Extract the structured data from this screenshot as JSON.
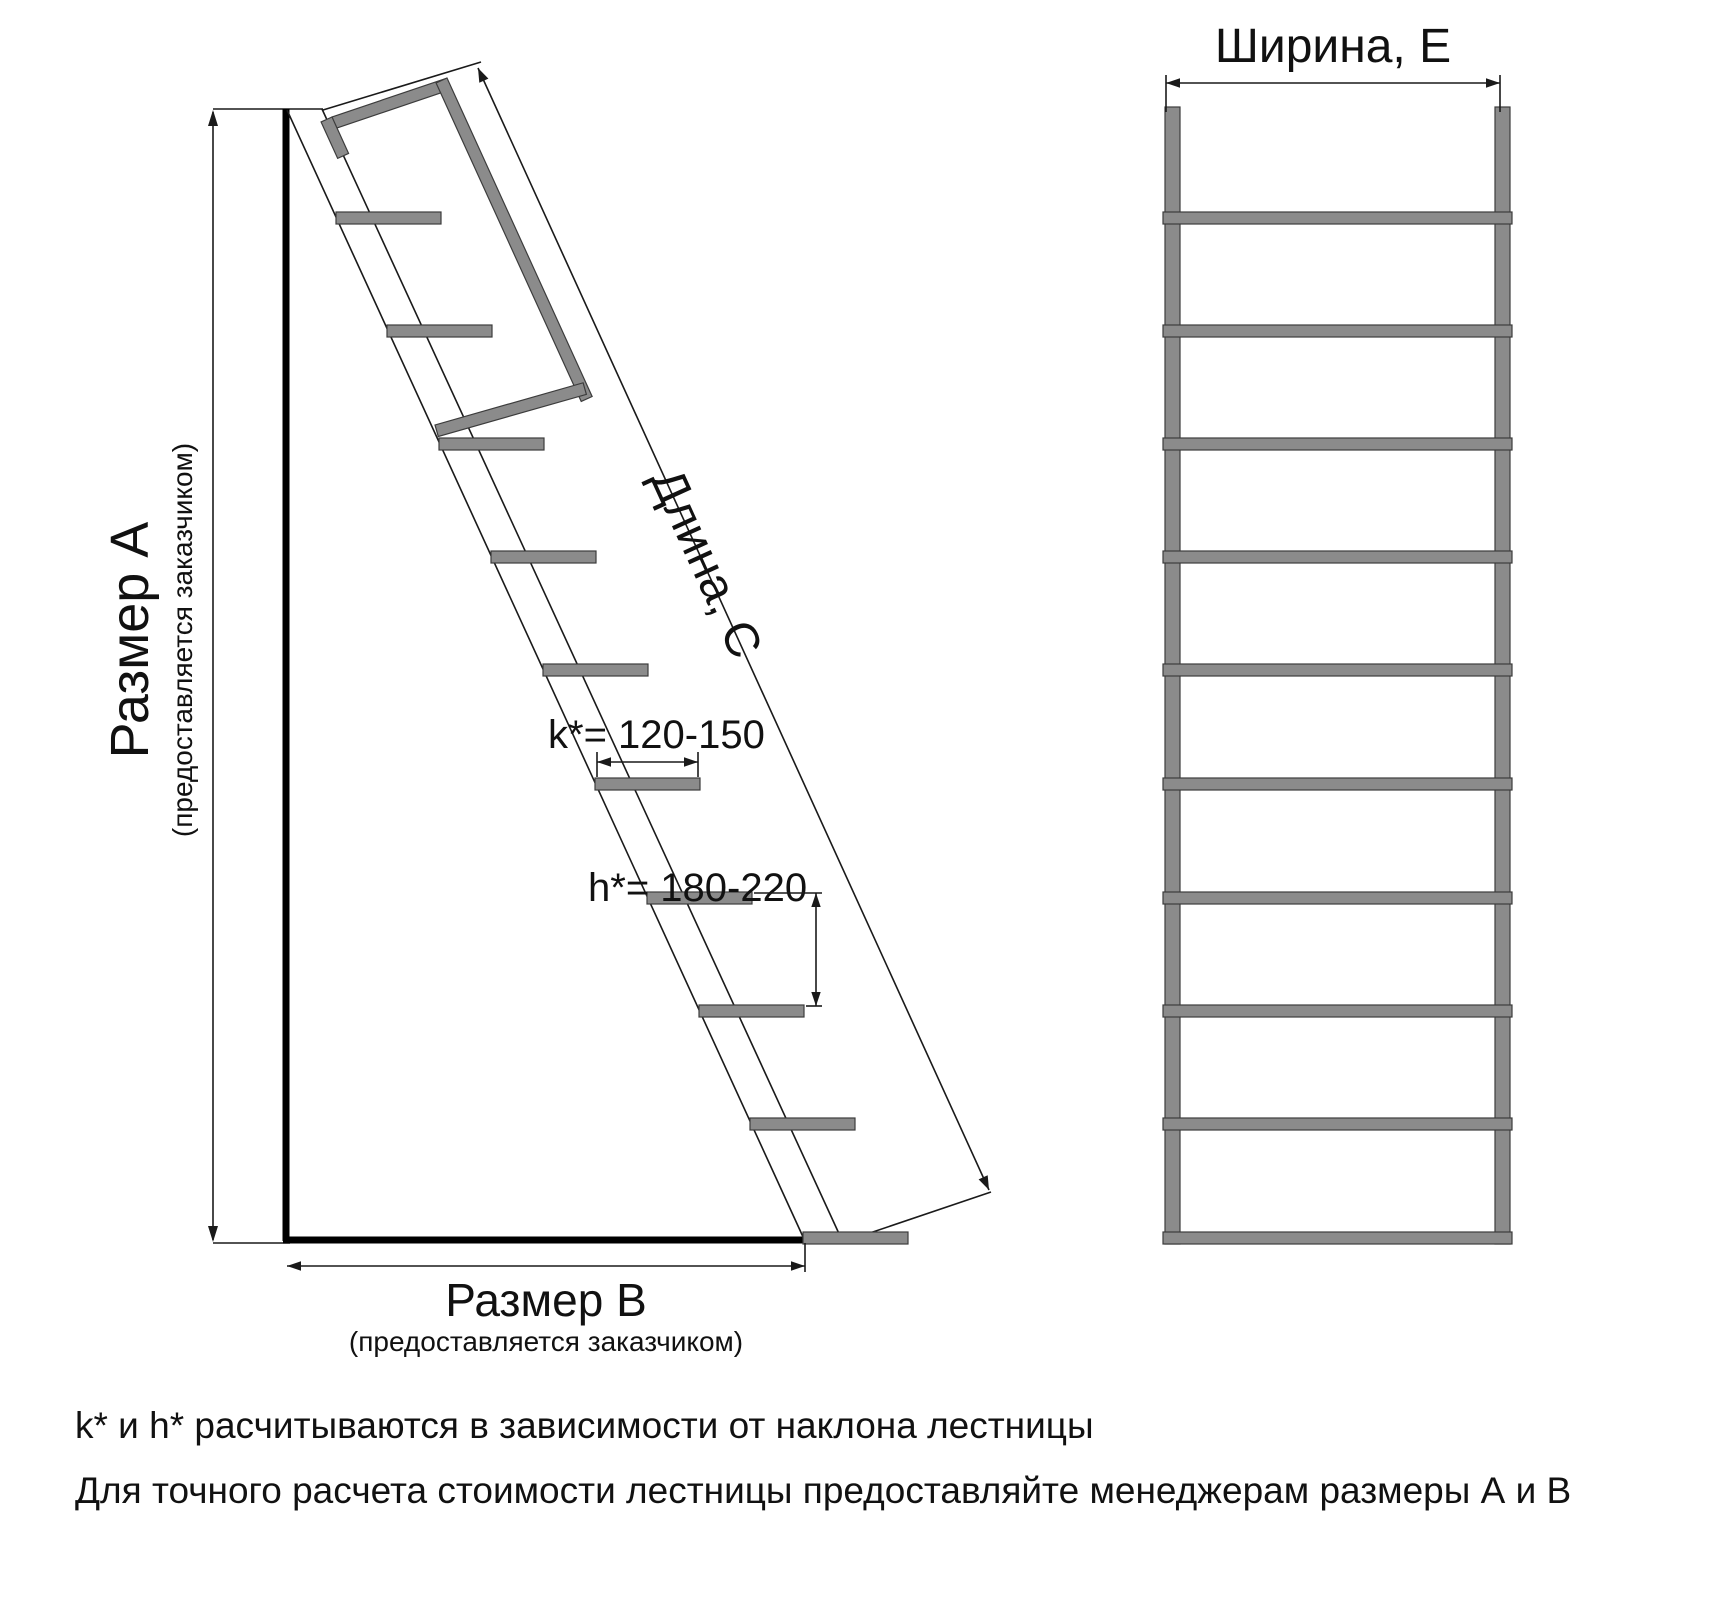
{
  "left_view": {
    "size_a_label": "Размер А",
    "size_a_note": "(предоставляется заказчиком)",
    "size_b_label": "Размер В",
    "size_b_note": "(предоставляется заказчиком)",
    "length_label": "Длина, С",
    "k_dimension": "k*= 120-150",
    "h_dimension": "h*= 180-220",
    "treads_count": 10
  },
  "front_view": {
    "width_label": "Ширина, Е",
    "rungs_count": 10
  },
  "footnotes": {
    "line1": "k* и h* расчитываются в зависимости от наклона лестницы",
    "line2": "Для точного расчета стоимости лестницы предоставляйте менеджерам размеры А и В"
  },
  "colors": {
    "steel_gray": "#8b8b8b",
    "steel_outline": "#3c3c3c",
    "line_color": "#1a1a1a"
  }
}
